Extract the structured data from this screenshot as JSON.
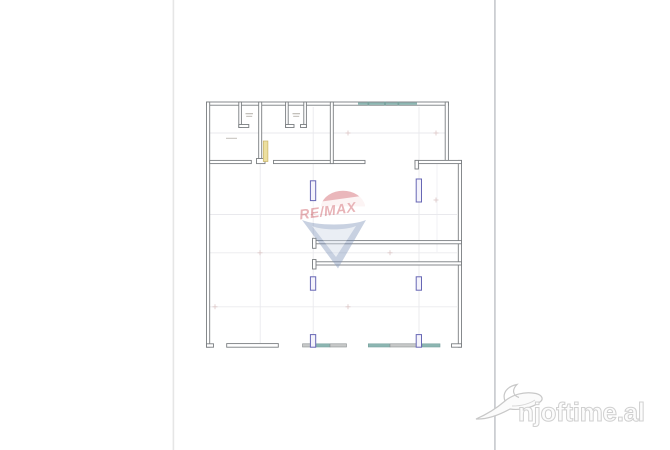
{
  "canvas": {
    "width": 670,
    "height": 450,
    "background": "#ffffff"
  },
  "photo_frame": {
    "left_edge_x": 173,
    "right_edge_x": 495
  },
  "floor_plan": {
    "wall_color": "#7a7e81",
    "window_color": "#8cb6b2",
    "column_color": "#6767b5",
    "column_fill": "#f4f3fb",
    "door_color": "#ecdf9f",
    "door_outline": "#c8b269",
    "grid_color": "#e9e9ed",
    "grid_cross_color": "#dcc7c7"
  },
  "watermarks": {
    "remax": {
      "text": "RE/MAX",
      "text_color": "#c94b55",
      "balloon_top_color": "#cf5660",
      "balloon_bottom_color": "#7d92b8"
    },
    "njoftime": {
      "text": "njoftime.al",
      "text_fill": "#fcfcfc",
      "text_outline": "#d0d0d0",
      "bird_color": "#c8c8c8"
    }
  }
}
